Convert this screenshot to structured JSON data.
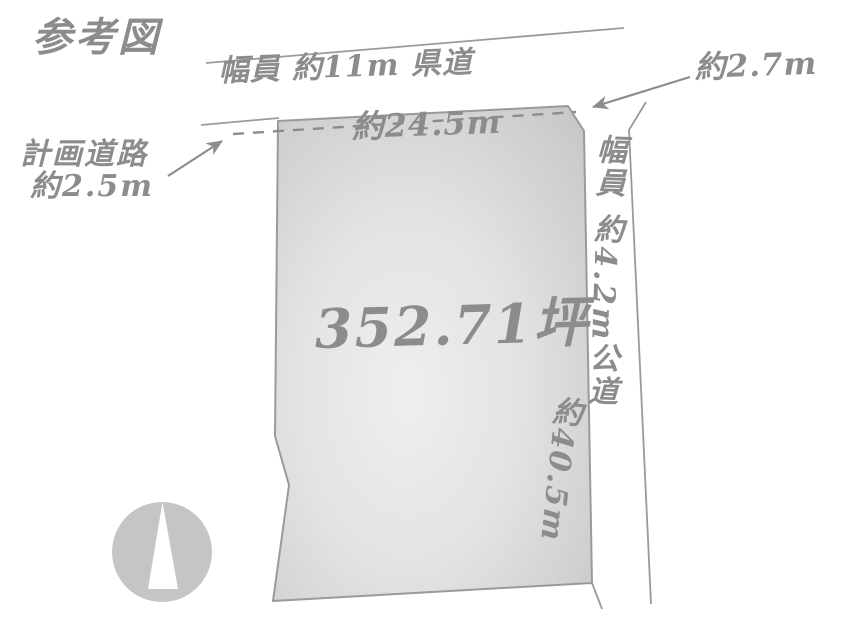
{
  "title": "参考図",
  "plot": {
    "area_label": "352.71坪",
    "top_edge_length": "約24.5m",
    "right_edge_length": "約40.5m",
    "corner_cut_length": "約2.7m"
  },
  "roads": {
    "top": {
      "label": "幅員 約11m 県道"
    },
    "right": {
      "label": "幅員 約4.2m公道"
    },
    "planned": {
      "name": "計画道路",
      "width": "約2.5m"
    }
  },
  "icons": {
    "compass": "north-arrow-compass-icon"
  },
  "colors": {
    "text_gray": "#8c8c8c",
    "line_gray": "#9a9a9a",
    "plot_fill_center": "#ececec",
    "plot_fill_edge": "#c8c8c8",
    "compass_fill": "#c5c5c5",
    "background": "#ffffff"
  }
}
